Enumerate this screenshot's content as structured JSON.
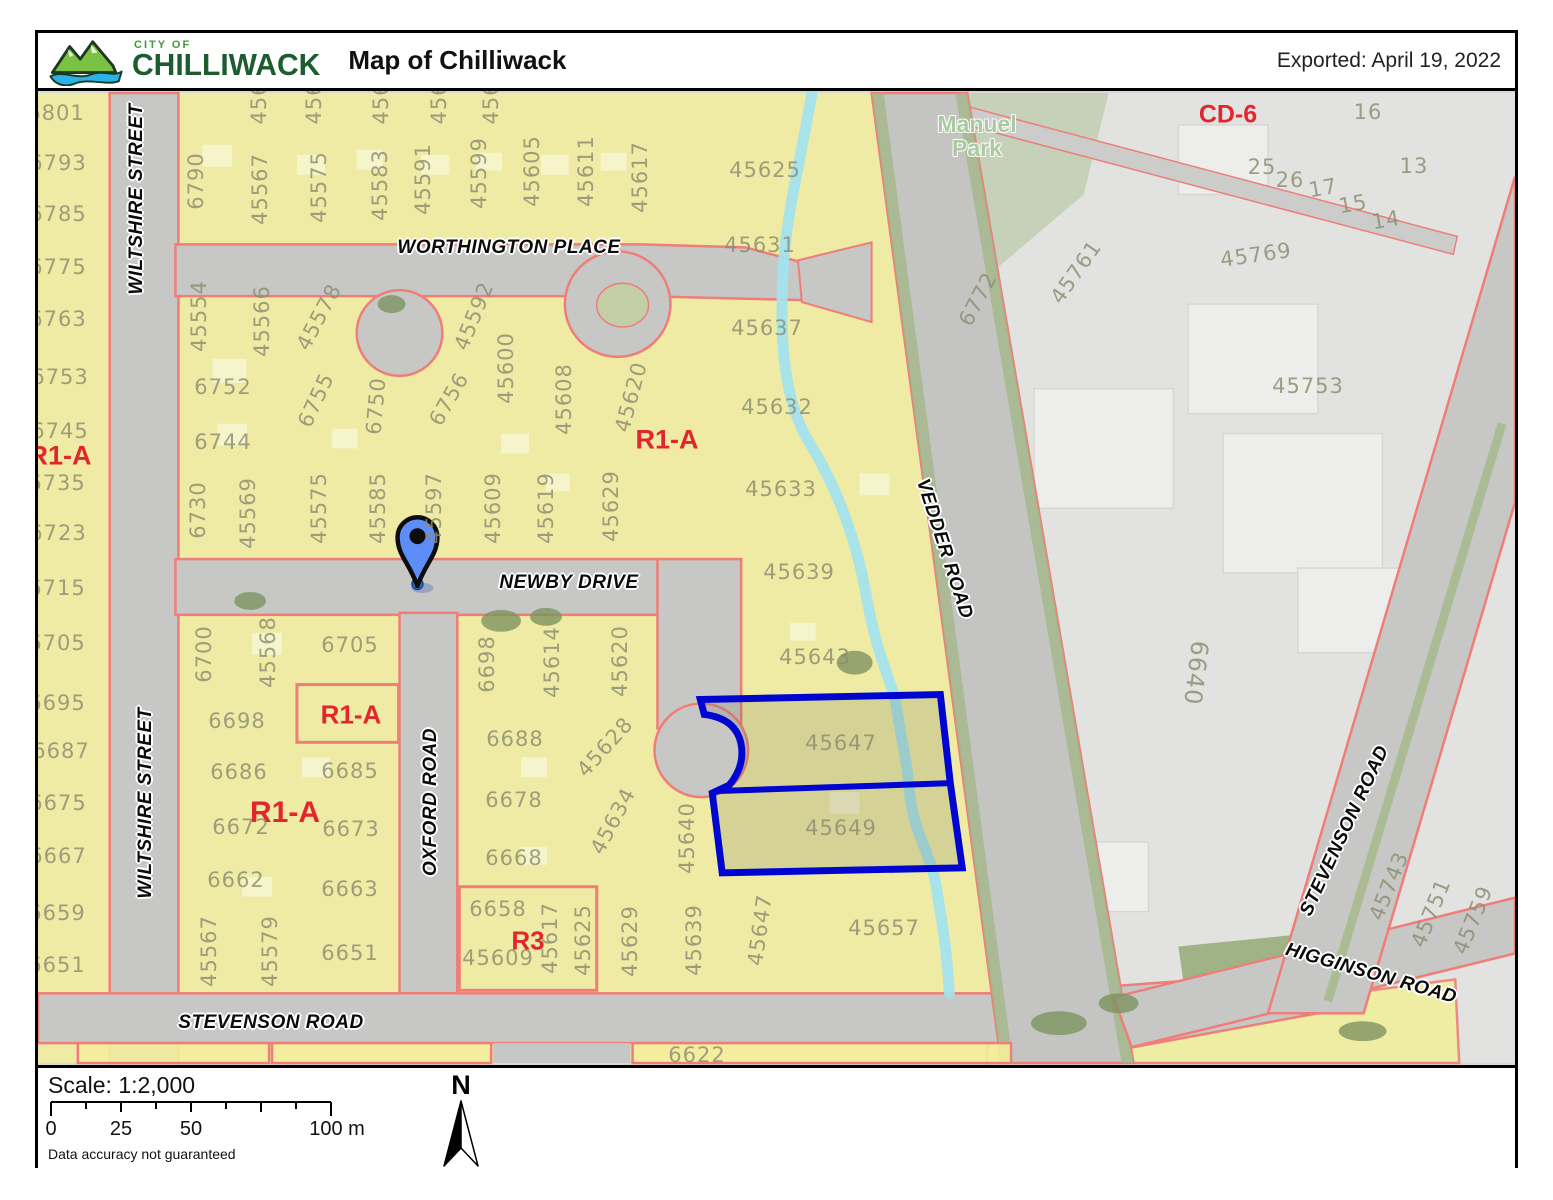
{
  "header": {
    "logo_top": "CITY OF",
    "logo_name": "CHILLIWACK",
    "title": "Map of Chilliwack",
    "exported": "Exported: April 19, 2022"
  },
  "footer": {
    "scale_label": "Scale: 1:2,000",
    "north": "N",
    "disclaimer": "Data accuracy not guaranteed",
    "ticks": [
      {
        "t": "0",
        "x": 13
      },
      {
        "t": "25",
        "x": 83
      },
      {
        "t": "50",
        "x": 153
      },
      {
        "t": "100 m",
        "x": 299
      }
    ]
  },
  "map": {
    "highlight_color": "#0006cf",
    "zone_fill_color": "#f2ee9c",
    "boundary_color": "#ef7d78",
    "creek_color": "#a2e3ec",
    "park": {
      "t": "Manuel\nPark",
      "x": 974,
      "y": 133
    },
    "zones": [
      {
        "t": "R1-A",
        "x": 57,
        "y": 453,
        "s": 27
      },
      {
        "t": "R1-A",
        "x": 664,
        "y": 437,
        "s": 27
      },
      {
        "t": "R1-A",
        "x": 348,
        "y": 712,
        "s": 26
      },
      {
        "t": "R1-A",
        "x": 282,
        "y": 810,
        "s": 30
      },
      {
        "t": "R3",
        "x": 525,
        "y": 938,
        "s": 26
      },
      {
        "t": "CD-6",
        "x": 1225,
        "y": 112,
        "s": 25
      }
    ],
    "roads": [
      {
        "t": "WILTSHIRE STREET",
        "x": 134,
        "y": 196,
        "r": -90
      },
      {
        "t": "WILTSHIRE STREET",
        "x": 143,
        "y": 800,
        "r": -90
      },
      {
        "t": "WORTHINGTON PLACE",
        "x": 506,
        "y": 245,
        "r": 0
      },
      {
        "t": "NEWBY DRIVE",
        "x": 566,
        "y": 580,
        "r": 0
      },
      {
        "t": "OXFORD ROAD",
        "x": 428,
        "y": 799,
        "r": -90
      },
      {
        "t": "VEDDER ROAD",
        "x": 941,
        "y": 546,
        "r": 72
      },
      {
        "t": "STEVENSON ROAD",
        "x": 268,
        "y": 1020,
        "r": 0
      },
      {
        "t": "STEVENSON ROAD",
        "x": 1342,
        "y": 828,
        "r": -65
      },
      {
        "t": "HIGGINSON ROAD",
        "x": 1368,
        "y": 971,
        "r": 16
      }
    ],
    "parcels": [
      {
        "t": "6801",
        "x": 53,
        "y": 110
      },
      {
        "t": "6793",
        "x": 55,
        "y": 160
      },
      {
        "t": "6785",
        "x": 55,
        "y": 211
      },
      {
        "t": "6775",
        "x": 55,
        "y": 264
      },
      {
        "t": "6763",
        "x": 55,
        "y": 316
      },
      {
        "t": "6753",
        "x": 57,
        "y": 374
      },
      {
        "t": "6745",
        "x": 57,
        "y": 428
      },
      {
        "t": "6735",
        "x": 54,
        "y": 480
      },
      {
        "t": "6723",
        "x": 55,
        "y": 530
      },
      {
        "t": "6715",
        "x": 54,
        "y": 585
      },
      {
        "t": "6705",
        "x": 54,
        "y": 640
      },
      {
        "t": "6695",
        "x": 54,
        "y": 700
      },
      {
        "t": "6687",
        "x": 58,
        "y": 748
      },
      {
        "t": "6675",
        "x": 55,
        "y": 800
      },
      {
        "t": "6667",
        "x": 55,
        "y": 853
      },
      {
        "t": "6659",
        "x": 54,
        "y": 910
      },
      {
        "t": "6651",
        "x": 54,
        "y": 962
      },
      {
        "t": "456",
        "x": 256,
        "y": 100,
        "r": -90
      },
      {
        "t": "456",
        "x": 311,
        "y": 100,
        "r": -90
      },
      {
        "t": "456",
        "x": 378,
        "y": 100,
        "r": -90
      },
      {
        "t": "456",
        "x": 436,
        "y": 100,
        "r": -90
      },
      {
        "t": "456",
        "x": 488,
        "y": 100,
        "r": -90
      },
      {
        "t": "6790",
        "x": 193,
        "y": 178,
        "r": -90
      },
      {
        "t": "45567",
        "x": 257,
        "y": 186,
        "r": -90
      },
      {
        "t": "45575",
        "x": 316,
        "y": 184,
        "r": -90
      },
      {
        "t": "45583",
        "x": 377,
        "y": 182,
        "r": -90
      },
      {
        "t": "45591",
        "x": 420,
        "y": 176,
        "r": -90
      },
      {
        "t": "45599",
        "x": 476,
        "y": 170,
        "r": -90
      },
      {
        "t": "45605",
        "x": 529,
        "y": 168,
        "r": -90
      },
      {
        "t": "45611",
        "x": 583,
        "y": 168,
        "r": -90
      },
      {
        "t": "45617",
        "x": 637,
        "y": 174,
        "r": -90
      },
      {
        "t": "45554",
        "x": 196,
        "y": 313,
        "r": -90
      },
      {
        "t": "45566",
        "x": 259,
        "y": 318,
        "r": -90
      },
      {
        "t": "45578",
        "x": 316,
        "y": 314,
        "r": -62
      },
      {
        "t": "45592",
        "x": 471,
        "y": 313,
        "r": -68
      },
      {
        "t": "45600",
        "x": 503,
        "y": 365,
        "r": -90
      },
      {
        "t": "45608",
        "x": 561,
        "y": 396,
        "r": -90
      },
      {
        "t": "45620",
        "x": 628,
        "y": 394,
        "r": -75
      },
      {
        "t": "6752",
        "x": 220,
        "y": 384
      },
      {
        "t": "6744",
        "x": 220,
        "y": 439
      },
      {
        "t": "6755",
        "x": 313,
        "y": 397,
        "r": -65
      },
      {
        "t": "6750",
        "x": 373,
        "y": 403,
        "r": -85
      },
      {
        "t": "6756",
        "x": 446,
        "y": 396,
        "r": -60
      },
      {
        "t": "6730",
        "x": 195,
        "y": 507,
        "r": -90
      },
      {
        "t": "45569",
        "x": 245,
        "y": 510,
        "r": -90
      },
      {
        "t": "45575",
        "x": 316,
        "y": 505,
        "r": -90
      },
      {
        "t": "45585",
        "x": 375,
        "y": 505,
        "r": -90
      },
      {
        "t": "45597",
        "x": 431,
        "y": 505,
        "r": -90
      },
      {
        "t": "45609",
        "x": 490,
        "y": 505,
        "r": -90
      },
      {
        "t": "45619",
        "x": 543,
        "y": 505,
        "r": -90
      },
      {
        "t": "45629",
        "x": 608,
        "y": 503,
        "r": -90
      },
      {
        "t": "45625",
        "x": 762,
        "y": 167
      },
      {
        "t": "45631",
        "x": 757,
        "y": 242
      },
      {
        "t": "45637",
        "x": 764,
        "y": 325
      },
      {
        "t": "45632",
        "x": 774,
        "y": 404
      },
      {
        "t": "45633",
        "x": 778,
        "y": 486
      },
      {
        "t": "45639",
        "x": 796,
        "y": 569
      },
      {
        "t": "45643",
        "x": 812,
        "y": 654
      },
      {
        "t": "45647",
        "x": 838,
        "y": 740
      },
      {
        "t": "45649",
        "x": 838,
        "y": 825
      },
      {
        "t": "6705",
        "x": 347,
        "y": 642
      },
      {
        "t": "45568",
        "x": 265,
        "y": 649,
        "r": -90
      },
      {
        "t": "6700",
        "x": 201,
        "y": 651,
        "r": -90
      },
      {
        "t": "6698",
        "x": 234,
        "y": 718
      },
      {
        "t": "6686",
        "x": 236,
        "y": 769
      },
      {
        "t": "6685",
        "x": 347,
        "y": 768
      },
      {
        "t": "6672",
        "x": 238,
        "y": 824
      },
      {
        "t": "6673",
        "x": 348,
        "y": 826
      },
      {
        "t": "6662",
        "x": 233,
        "y": 877
      },
      {
        "t": "6663",
        "x": 347,
        "y": 886
      },
      {
        "t": "45567",
        "x": 206,
        "y": 948,
        "r": -90
      },
      {
        "t": "45579",
        "x": 267,
        "y": 948,
        "r": -90
      },
      {
        "t": "6651",
        "x": 347,
        "y": 950
      },
      {
        "t": "6698",
        "x": 484,
        "y": 661,
        "r": -90
      },
      {
        "t": "45614",
        "x": 549,
        "y": 659,
        "r": -90
      },
      {
        "t": "45620",
        "x": 617,
        "y": 658,
        "r": -90
      },
      {
        "t": "6688",
        "x": 512,
        "y": 736
      },
      {
        "t": "45628",
        "x": 602,
        "y": 744,
        "r": -48
      },
      {
        "t": "6678",
        "x": 511,
        "y": 797
      },
      {
        "t": "45634",
        "x": 610,
        "y": 818,
        "r": -62
      },
      {
        "t": "6668",
        "x": 511,
        "y": 855
      },
      {
        "t": "45640",
        "x": 684,
        "y": 835,
        "r": -90
      },
      {
        "t": "6658",
        "x": 495,
        "y": 906
      },
      {
        "t": "45609",
        "x": 495,
        "y": 955
      },
      {
        "t": "45617",
        "x": 547,
        "y": 935,
        "r": -90
      },
      {
        "t": "45625",
        "x": 580,
        "y": 937,
        "r": -90
      },
      {
        "t": "45629",
        "x": 627,
        "y": 938,
        "r": -90
      },
      {
        "t": "45639",
        "x": 691,
        "y": 937,
        "r": -90
      },
      {
        "t": "45647",
        "x": 757,
        "y": 927,
        "r": -82
      },
      {
        "t": "45657",
        "x": 881,
        "y": 925
      },
      {
        "t": "6622",
        "x": 694,
        "y": 1052
      },
      {
        "t": "16",
        "x": 1365,
        "y": 109
      },
      {
        "t": "25",
        "x": 1259,
        "y": 164
      },
      {
        "t": "26",
        "x": 1287,
        "y": 177
      },
      {
        "t": "17",
        "x": 1320,
        "y": 185,
        "r": -10
      },
      {
        "t": "15",
        "x": 1350,
        "y": 201,
        "r": -10
      },
      {
        "t": "14",
        "x": 1383,
        "y": 217,
        "r": -10
      },
      {
        "t": "13",
        "x": 1411,
        "y": 163
      },
      {
        "t": "45769",
        "x": 1253,
        "y": 252,
        "r": -8
      },
      {
        "t": "45761",
        "x": 1073,
        "y": 269,
        "r": -55
      },
      {
        "t": "6772",
        "x": 975,
        "y": 296,
        "r": -62
      },
      {
        "t": "45753",
        "x": 1305,
        "y": 383
      },
      {
        "t": "6640",
        "x": 1193,
        "y": 670,
        "r": 97,
        "s": 24
      },
      {
        "t": "45743",
        "x": 1386,
        "y": 883,
        "r": -68
      },
      {
        "t": "45751",
        "x": 1428,
        "y": 910,
        "r": -68
      },
      {
        "t": "45759",
        "x": 1470,
        "y": 917,
        "r": -68
      }
    ]
  }
}
